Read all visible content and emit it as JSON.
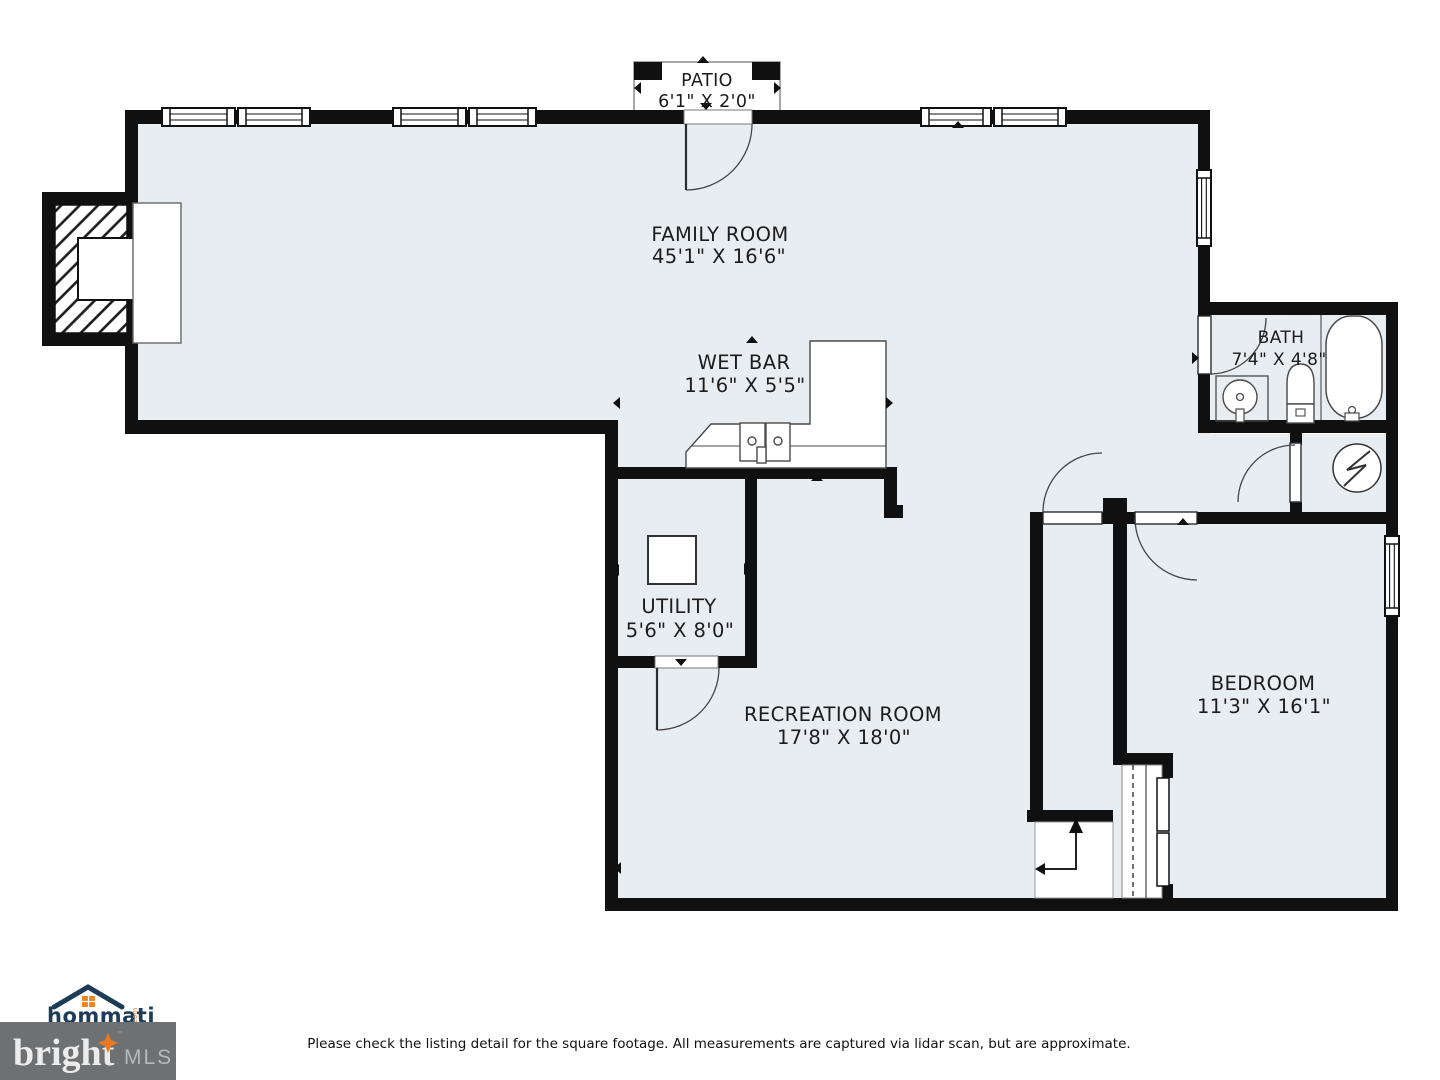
{
  "plan": {
    "patio": {
      "name": "PATIO",
      "dims": "6'1\" X 2'0\""
    },
    "family_room": {
      "name": "FAMILY ROOM",
      "dims": "45'1\" X 16'6\""
    },
    "wet_bar": {
      "name": "WET BAR",
      "dims": "11'6\" X 5'5\""
    },
    "bath": {
      "name": "BATH",
      "dims": "7'4\" X 4'8\""
    },
    "utility": {
      "name": "UTILITY",
      "dims": "5'6\" X 8'0\""
    },
    "recreation_room": {
      "name": "RECREATION ROOM",
      "dims": "17'8\" X 18'0\""
    },
    "bedroom": {
      "name": "BEDROOM",
      "dims": "11'3\" X 16'1\""
    }
  },
  "footer": {
    "disclaimer": "Please check the listing detail for the square footage. All measurements are captured via lidar scan, but are approximate."
  },
  "branding": {
    "hommati": {
      "word": "hommati",
      "tld": ".com"
    },
    "bright": {
      "word": "bright",
      "suffix": "MLS",
      "tm": "™"
    }
  },
  "icons": {
    "fireplace_icon": "hatched-firebox",
    "water_heater_icon": "circle-lightning",
    "bathtub_icon": "rounded-tub",
    "toilet_icon": "tank-and-bowl",
    "sink_icon": "circle-basin",
    "double_sink_icon": "two-basins",
    "stairs_up_icon": "l-arrow",
    "house_icon": "roof-chevron",
    "star_icon": "four-point-sparkle"
  },
  "colors": {
    "wall": "#101010",
    "floor": "#e8edf2",
    "accent_orange": "#ee8322",
    "navy": "#1d3c57",
    "bright_box_gray": "#6f7072"
  }
}
